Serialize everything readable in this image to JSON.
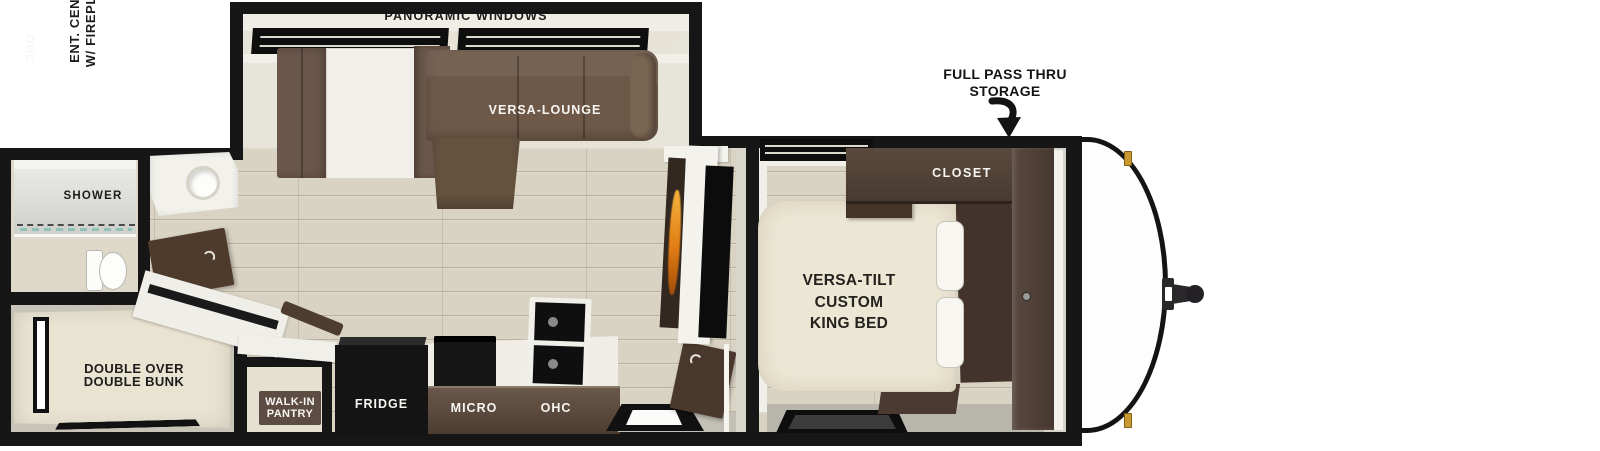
{
  "diagram": {
    "type": "travel-trailer-floorplan",
    "labels": {
      "panoramic_windows": "PANORAMIC WINDOWS",
      "versa_lounge": "VERSA-LOUNGE",
      "storage_callout": {
        "line1": "FULL PASS THRU",
        "line2": "STORAGE"
      },
      "closet": "CLOSET",
      "bedroom_ohc": "OHC",
      "king_bed": {
        "line1": "VERSA-TILT",
        "line2": "CUSTOM",
        "line3": "KING BED"
      },
      "ent_center": {
        "line1": "ENT. CENTER",
        "line2": "W/ FIREPLACE"
      },
      "shower": "SHOWER",
      "bunk": {
        "line1": "DOUBLE OVER",
        "line2": "DOUBLE BUNK"
      },
      "pantry": {
        "line1": "WALK-IN",
        "line2": "PANTRY"
      },
      "fridge": "FRIDGE",
      "micro": "MICRO",
      "kitchen_ohc": "OHC"
    },
    "colors": {
      "wall_black": "#161616",
      "floor_beige": "#d9d3c3",
      "sofa_brown": "#6e5949",
      "cabinet_wood": "#4c3c30",
      "bed_cream": "#ece6d4",
      "flame_orange": "#e07c14",
      "marker_light_gold": "#c9992f"
    }
  }
}
